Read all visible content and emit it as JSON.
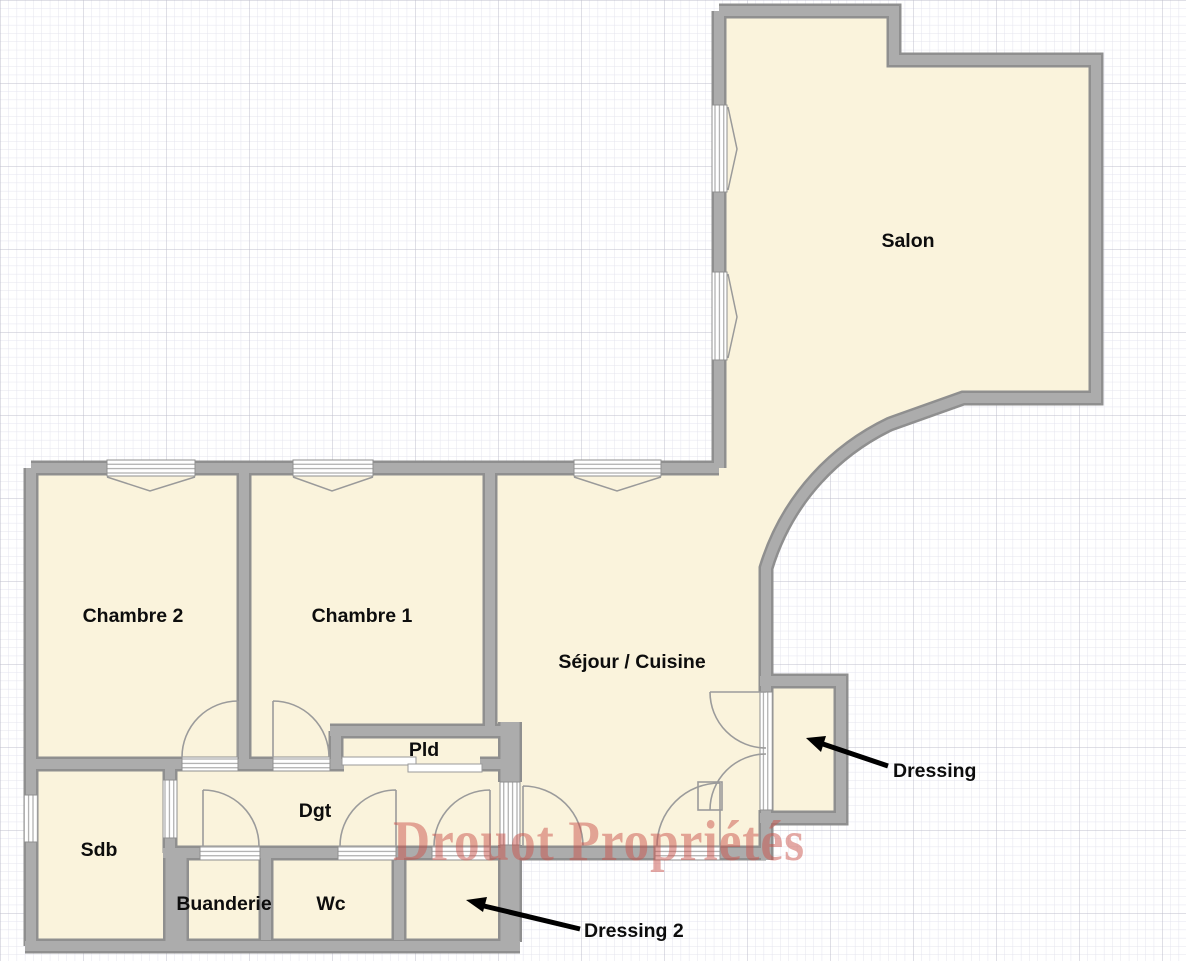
{
  "plan": {
    "watermark": "Drouot Propriétés",
    "rooms": {
      "salon": "Salon",
      "chambre2": "Chambre 2",
      "chambre1": "Chambre 1",
      "sejour_cuisine": "Séjour / Cuisine",
      "pld": "Pld",
      "dgt": "Dgt",
      "sdb": "Sdb",
      "buanderie": "Buanderie",
      "wc": "Wc"
    },
    "annotations": {
      "dressing": "Dressing",
      "dressing2": "Dressing 2"
    },
    "colors": {
      "background": "#FFFFFF",
      "room_fill": "#FAF3DC",
      "wall_core": "#ACACAC",
      "wall_edge": "#8F8F8F",
      "door_line": "#9B9B9B",
      "opening_line": "#9A9A9A",
      "label": "#0D0D0D",
      "arrow": "#000000",
      "watermark": "rgba(201,84,76,0.5)",
      "grid_minor": "#E4E4EE",
      "grid_major": "#BFBFCC"
    }
  }
}
